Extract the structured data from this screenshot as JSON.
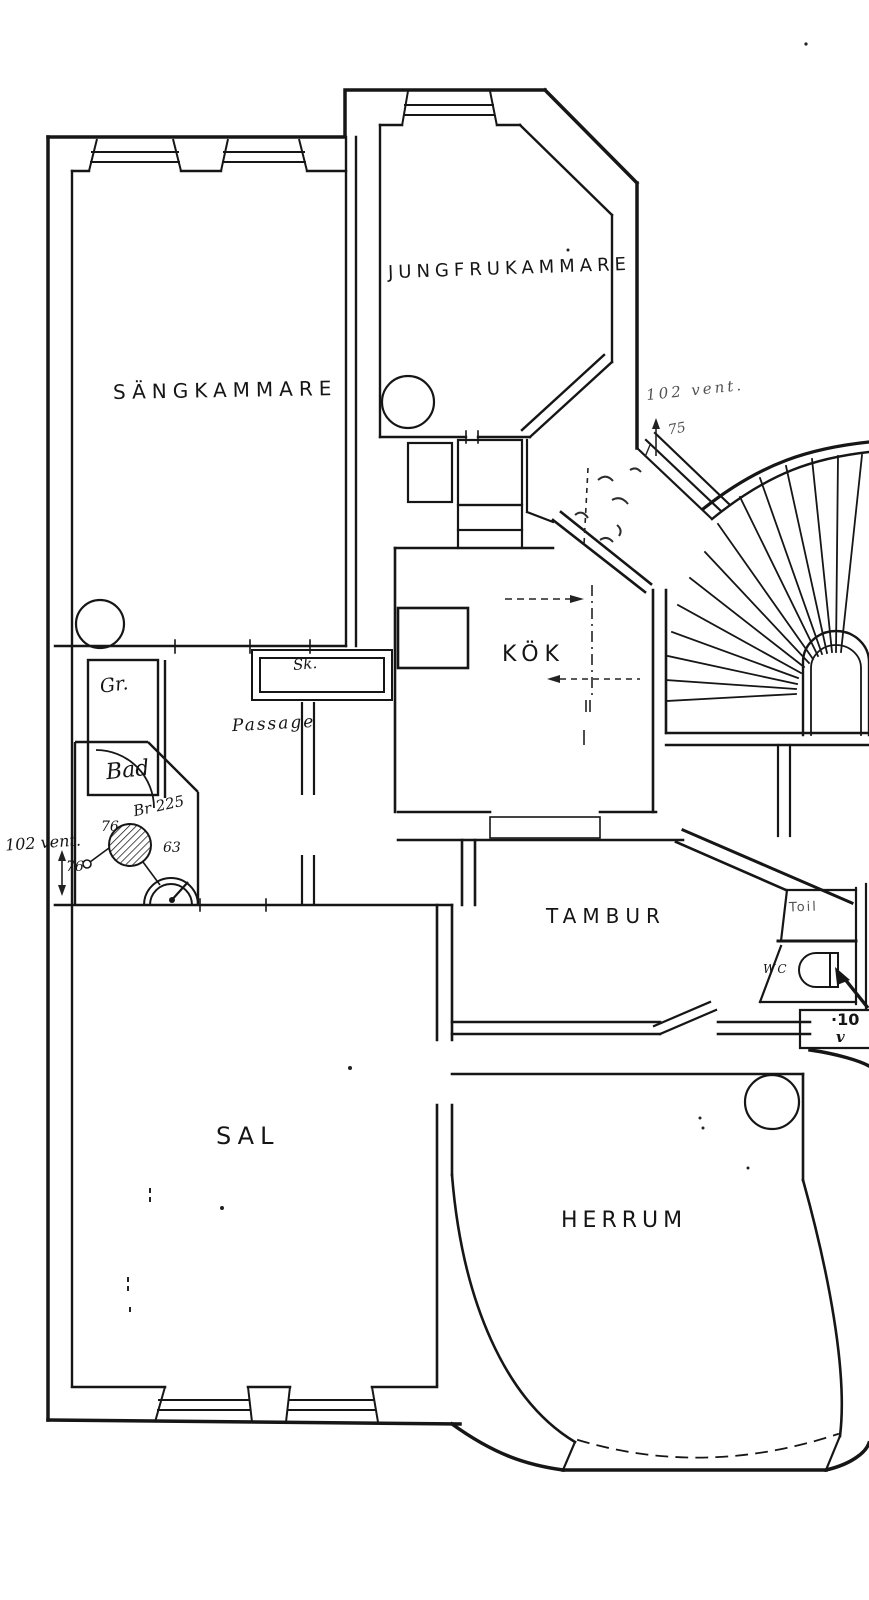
{
  "page": {
    "title": "Hand-drawn apartment floor plan (Swedish)",
    "background": "#ffffff",
    "ink": "#161616"
  },
  "rooms": {
    "sangkammare": {
      "label": "SÄNGKAMMARE"
    },
    "jungfrukammare": {
      "label": "JUNGFRUKAMMARE"
    },
    "kok": {
      "label": "KÖK"
    },
    "tambur": {
      "label": "TAMBUR"
    },
    "sal": {
      "label": "SAL"
    },
    "herrum": {
      "label": "HERRUM"
    },
    "bad": {
      "label": "Bad"
    },
    "garderob": {
      "label": "Gr."
    },
    "skafferi": {
      "label": "Sk."
    },
    "passage": {
      "label": "Passage"
    },
    "toilette": {
      "label": "Toil"
    },
    "wc": {
      "label": "WC"
    }
  },
  "annotations": {
    "left_vent": {
      "text": "102 vent."
    },
    "left_vent_width": {
      "text": "76"
    },
    "bath_width": {
      "text": "76"
    },
    "bath_boiler": {
      "text": "Br 225"
    },
    "bath_63": {
      "text": "63"
    },
    "right_vent": {
      "text": "102 vent."
    },
    "right_vent_width": {
      "text": "75"
    },
    "edge_cut_line1": {
      "text": "·10"
    },
    "edge_cut_line2": {
      "text": "v"
    }
  },
  "fixtures": [
    "round-stove-sangkammare",
    "round-stove-jungfrukammare",
    "round-stove-herrum",
    "bath-drain-hatched",
    "wash-basin",
    "wc-bowl",
    "fan-staircase"
  ]
}
